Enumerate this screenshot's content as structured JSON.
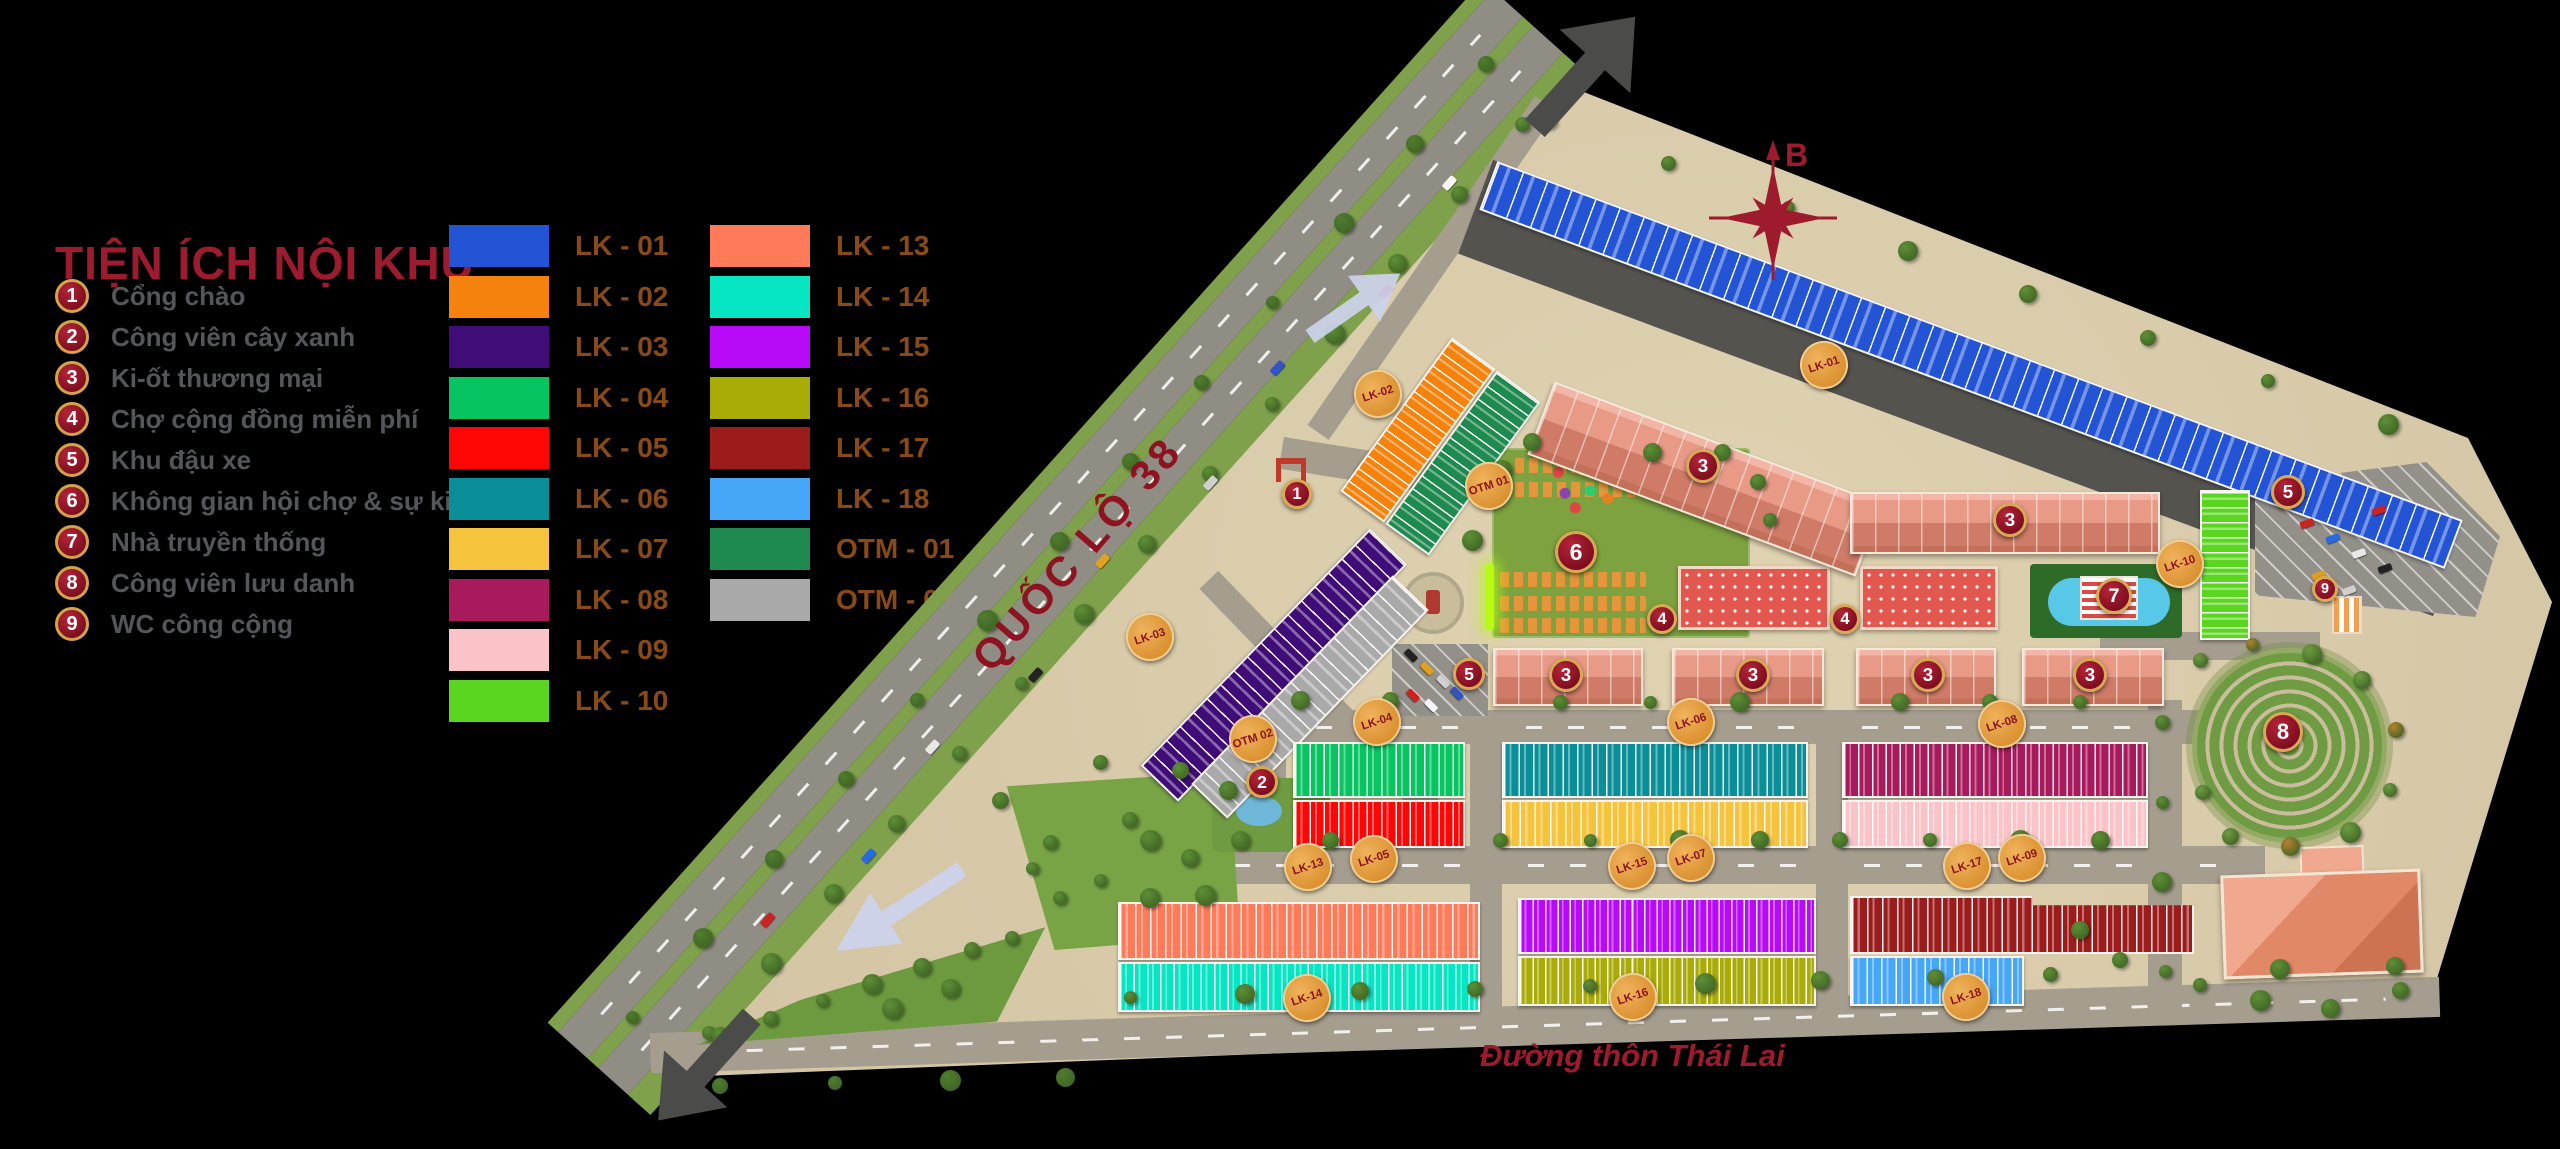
{
  "legend": {
    "title": "TIỆN ÍCH NỘI KHU",
    "items": [
      {
        "num": "1",
        "label": "Cổng chào"
      },
      {
        "num": "2",
        "label": "Công viên cây xanh"
      },
      {
        "num": "3",
        "label": "Ki-ốt thương mại"
      },
      {
        "num": "4",
        "label": "Chợ cộng đồng miễn phí"
      },
      {
        "num": "5",
        "label": "Khu đậu xe"
      },
      {
        "num": "6",
        "label": "Không gian hội chợ & sự kiện"
      },
      {
        "num": "7",
        "label": "Nhà truyền thống"
      },
      {
        "num": "8",
        "label": "Công viên lưu danh"
      },
      {
        "num": "9",
        "label": "WC công cộng"
      }
    ],
    "swatches_col1": [
      {
        "code": "LK - 01",
        "color": "#2454D6"
      },
      {
        "code": "LK - 02",
        "color": "#F5820C"
      },
      {
        "code": "LK - 03",
        "color": "#400D78"
      },
      {
        "code": "LK - 04",
        "color": "#06C45F"
      },
      {
        "code": "LK - 05",
        "color": "#FE0606"
      },
      {
        "code": "LK - 06",
        "color": "#0A8F99"
      },
      {
        "code": "LK - 07",
        "color": "#F6C33C"
      },
      {
        "code": "LK - 08",
        "color": "#A81A5C"
      },
      {
        "code": "LK - 09",
        "color": "#F9C3C7"
      },
      {
        "code": "LK - 10",
        "color": "#5AD520"
      }
    ],
    "swatches_col2": [
      {
        "code": "LK - 13",
        "color": "#FE7A58"
      },
      {
        "code": "LK - 14",
        "color": "#06E6C3"
      },
      {
        "code": "LK - 15",
        "color": "#B80AF9"
      },
      {
        "code": "LK - 16",
        "color": "#A9AB06"
      },
      {
        "code": "LK - 17",
        "color": "#9C1C1C"
      },
      {
        "code": "LK - 18",
        "color": "#46A6F8"
      },
      {
        "code": "OTM - 01",
        "color": "#1F8A50"
      },
      {
        "code": "OTM - 02",
        "color": "#A9A9A9"
      }
    ]
  },
  "map": {
    "compass_label": "B",
    "highway_label": "QUỐC LỘ 38",
    "south_road_label": "Đường thôn Thái Lai",
    "number_badges": [
      {
        "n": "1",
        "x": 1297,
        "y": 494,
        "s": 30
      },
      {
        "n": "2",
        "x": 1262,
        "y": 782,
        "s": 32
      },
      {
        "n": "3",
        "x": 1703,
        "y": 466,
        "s": 34
      },
      {
        "n": "3",
        "x": 2010,
        "y": 520,
        "s": 34
      },
      {
        "n": "3",
        "x": 1566,
        "y": 675,
        "s": 34
      },
      {
        "n": "3",
        "x": 1753,
        "y": 675,
        "s": 34
      },
      {
        "n": "3",
        "x": 1928,
        "y": 675,
        "s": 34
      },
      {
        "n": "3",
        "x": 2090,
        "y": 675,
        "s": 34
      },
      {
        "n": "4",
        "x": 1662,
        "y": 619,
        "s": 30
      },
      {
        "n": "4",
        "x": 1845,
        "y": 619,
        "s": 30
      },
      {
        "n": "5",
        "x": 1469,
        "y": 674,
        "s": 32
      },
      {
        "n": "5",
        "x": 2288,
        "y": 492,
        "s": 34
      },
      {
        "n": "6",
        "x": 1576,
        "y": 552,
        "s": 42
      },
      {
        "n": "7",
        "x": 2114,
        "y": 596,
        "s": 36
      },
      {
        "n": "8",
        "x": 2283,
        "y": 732,
        "s": 40
      },
      {
        "n": "9",
        "x": 2325,
        "y": 589,
        "s": 26
      }
    ],
    "block_badges": [
      {
        "label": "LK-01",
        "x": 1824,
        "y": 365
      },
      {
        "label": "LK-02",
        "x": 1378,
        "y": 394
      },
      {
        "label": "LK-03",
        "x": 1150,
        "y": 637
      },
      {
        "label": "LK-04",
        "x": 1377,
        "y": 722
      },
      {
        "label": "LK-05",
        "x": 1374,
        "y": 859
      },
      {
        "label": "LK-06",
        "x": 1691,
        "y": 722
      },
      {
        "label": "LK-07",
        "x": 1691,
        "y": 858
      },
      {
        "label": "LK-08",
        "x": 2002,
        "y": 724
      },
      {
        "label": "LK-09",
        "x": 2022,
        "y": 858
      },
      {
        "label": "LK-10",
        "x": 2180,
        "y": 564
      },
      {
        "label": "LK-13",
        "x": 1308,
        "y": 867
      },
      {
        "label": "LK-14",
        "x": 1307,
        "y": 998
      },
      {
        "label": "LK-15",
        "x": 1632,
        "y": 866
      },
      {
        "label": "LK-16",
        "x": 1633,
        "y": 997
      },
      {
        "label": "LK-17",
        "x": 1967,
        "y": 866
      },
      {
        "label": "LK-18",
        "x": 1966,
        "y": 997
      },
      {
        "label": "OTM 01",
        "x": 1489,
        "y": 486
      },
      {
        "label": "OTM 02",
        "x": 1253,
        "y": 739
      }
    ],
    "blocks": [
      {
        "code": "LK-01",
        "color": "#2454D6",
        "x": 1456,
        "y": 339,
        "w": 1030,
        "h": 52,
        "rot": 20.4,
        "dir": "v",
        "lots": 40
      },
      {
        "code": "LK-02",
        "color": "#F5820C",
        "x": 1391,
        "y": 335,
        "w": 54,
        "h": 190,
        "rot": 36,
        "dir": "h",
        "lots": 12
      },
      {
        "code": "OTM-01",
        "color": "#1F8A50",
        "x": 1436,
        "y": 368,
        "w": 54,
        "h": 190,
        "rot": 36,
        "dir": "h",
        "lots": 12
      },
      {
        "code": "LK-03",
        "color": "#400D78",
        "x": 1248,
        "y": 500,
        "w": 52,
        "h": 330,
        "rot": 44,
        "dir": "h",
        "lots": 17
      },
      {
        "code": "OTM-02",
        "color": "#A9A9A9",
        "x": 1285,
        "y": 552,
        "w": 50,
        "h": 290,
        "rot": 44,
        "dir": "h",
        "lots": 14
      },
      {
        "code": "LK-04",
        "color": "#06C45F",
        "x": 1293,
        "y": 742,
        "w": 172,
        "h": 56,
        "rot": 0,
        "dir": "v",
        "lots": 12
      },
      {
        "code": "LK-05",
        "color": "#FE0606",
        "x": 1293,
        "y": 800,
        "w": 172,
        "h": 48,
        "rot": 0,
        "dir": "v",
        "lots": 12
      },
      {
        "code": "LK-06",
        "color": "#0A8F99",
        "x": 1502,
        "y": 742,
        "w": 306,
        "h": 56,
        "rot": 0,
        "dir": "v",
        "lots": 21
      },
      {
        "code": "LK-07",
        "color": "#F6C33C",
        "x": 1502,
        "y": 800,
        "w": 306,
        "h": 48,
        "rot": 0,
        "dir": "v",
        "lots": 20
      },
      {
        "code": "LK-08",
        "color": "#A81A5C",
        "x": 1842,
        "y": 742,
        "w": 306,
        "h": 56,
        "rot": 0,
        "dir": "v",
        "lots": 22
      },
      {
        "code": "LK-09",
        "color": "#F9C3C7",
        "x": 1842,
        "y": 800,
        "w": 306,
        "h": 48,
        "rot": 0,
        "dir": "v",
        "lots": 22
      },
      {
        "code": "LK-10",
        "color": "#5AD520",
        "x": 2200,
        "y": 490,
        "w": 50,
        "h": 150,
        "rot": 0,
        "dir": "h",
        "lots": 10
      },
      {
        "code": "LK-13",
        "color": "#FE7A58",
        "x": 1118,
        "y": 902,
        "w": 362,
        "h": 58,
        "rot": 0,
        "dir": "v",
        "lots": 24
      },
      {
        "code": "LK-14",
        "color": "#06E6C3",
        "x": 1118,
        "y": 962,
        "w": 362,
        "h": 50,
        "rot": 0,
        "dir": "v",
        "lots": 27
      },
      {
        "code": "LK-15",
        "color": "#B80AF9",
        "x": 1518,
        "y": 898,
        "w": 298,
        "h": 56,
        "rot": 0,
        "dir": "v",
        "lots": 24
      },
      {
        "code": "LK-16",
        "color": "#A9AB06",
        "x": 1518,
        "y": 956,
        "w": 298,
        "h": 50,
        "rot": 0,
        "dir": "v",
        "lots": 24
      },
      {
        "code": "LK-17",
        "color": "#9C1C1C",
        "x": 1850,
        "y": 896,
        "w": 344,
        "h": 58,
        "rot": 0,
        "dir": "v",
        "lots": 23,
        "clip": "polygon(0 0,53% 0,53% 16%,100% 16%,100% 100%,0 100%)"
      },
      {
        "code": "LK-18",
        "color": "#46A6F8",
        "x": 1850,
        "y": 956,
        "w": 174,
        "h": 50,
        "rot": 0,
        "dir": "v",
        "lots": 12
      }
    ]
  }
}
